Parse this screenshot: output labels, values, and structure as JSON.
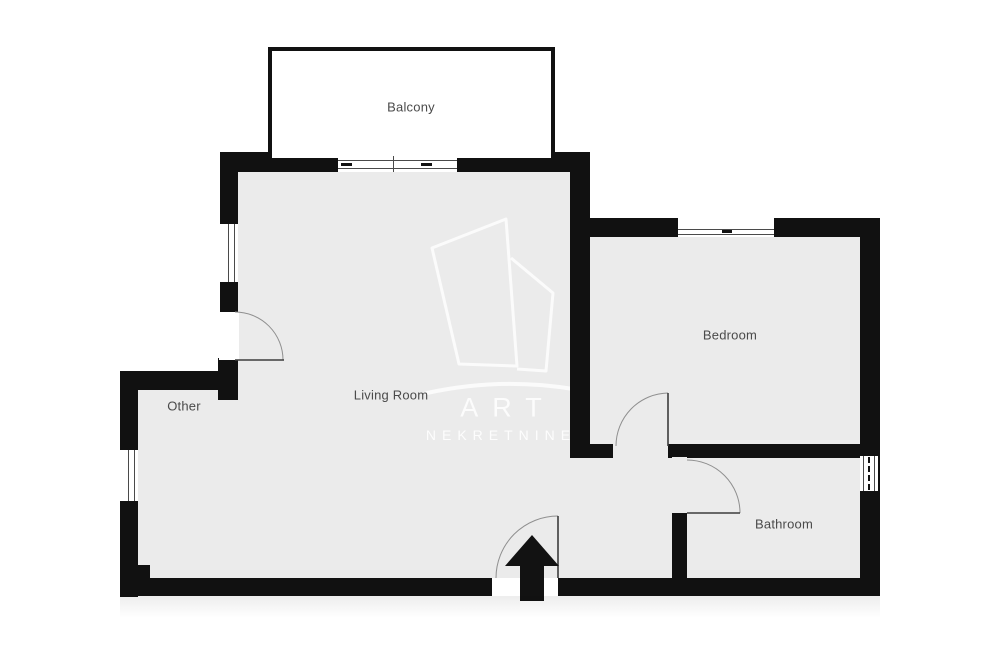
{
  "page": {
    "type": "apartment-floor-plan",
    "background": "#ffffff"
  },
  "rooms": [
    {
      "id": "balcony",
      "label": "Balcony"
    },
    {
      "id": "living-room",
      "label": "Living Room"
    },
    {
      "id": "other",
      "label": "Other"
    },
    {
      "id": "bedroom",
      "label": "Bedroom"
    },
    {
      "id": "bathroom",
      "label": "Bathroom"
    }
  ],
  "watermark": {
    "brand": "ART",
    "subtitle": "NEKRETNINE"
  },
  "entrance": {
    "marker": "up-arrow"
  },
  "features": {
    "doors": [
      "living-room-side-door",
      "entrance-door",
      "bedroom-door",
      "bathroom-door"
    ],
    "windows": [
      "balcony-sliding-door",
      "living-room-left-window",
      "bedroom-window",
      "other-left-window",
      "bathroom-right-window"
    ]
  },
  "colors": {
    "wall": "#111111",
    "floor": "#ebebeb",
    "exterior": "#ffffff",
    "label_text": "#4a4a4a",
    "door_arc": "#8f8f8f",
    "watermark": "#ffffff"
  }
}
